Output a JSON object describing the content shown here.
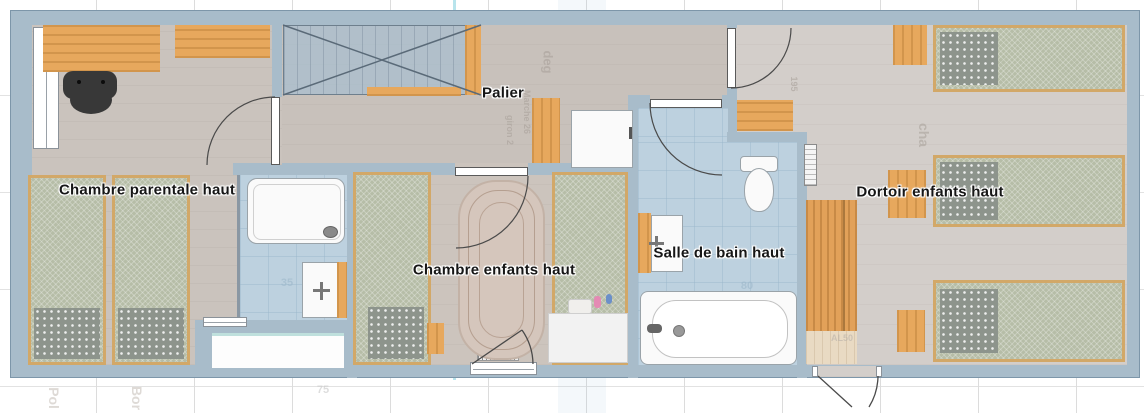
{
  "plan": {
    "title": "Upper floor plan",
    "floor_note": "haut"
  },
  "rooms": {
    "parentale": {
      "label": "Chambre parentale haut"
    },
    "palier": {
      "label": "Palier"
    },
    "enfants": {
      "label": "Chambre enfants haut"
    },
    "salle_de_bain": {
      "label": "Salle de bain haut"
    },
    "dortoir": {
      "label": "Dortoir enfants haut"
    }
  },
  "colors": {
    "wall": "#a8bcca",
    "wall_outline": "#7d96a9",
    "floor_wood": "#cac3bd",
    "floor_dortoir": "#d3ceca",
    "tile_bathroom": "#bdd1df",
    "furniture_wood": "#e7a85d",
    "mattress": "#b6bda7",
    "bed_frame": "#d2a868",
    "blanket": "#8d948c",
    "grid": "#dcdcdc",
    "label_text": "#161616"
  },
  "watermarks": [
    {
      "text": "deg"
    },
    {
      "text": "Marche 26"
    },
    {
      "text": "giron 2"
    },
    {
      "text": "cha"
    },
    {
      "text": "195"
    },
    {
      "text": "35"
    },
    {
      "text": "80"
    },
    {
      "text": "AL50"
    },
    {
      "text": "75"
    },
    {
      "text": "Pol"
    },
    {
      "text": "Bor"
    }
  ]
}
